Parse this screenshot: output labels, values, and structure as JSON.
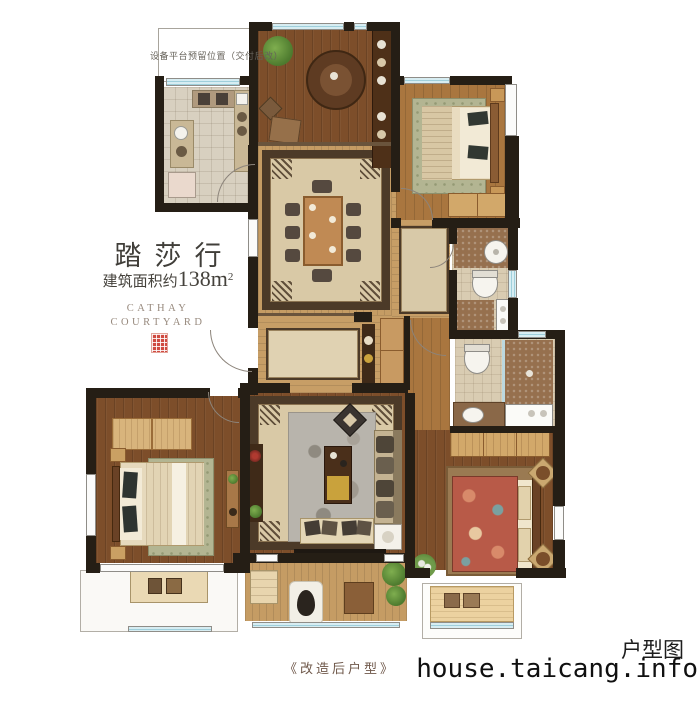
{
  "texts": {
    "platform_note": "设备平台预留位置（交付后改）",
    "title": "踏莎行",
    "area_prefix": "建筑面积约",
    "area_number": "138m",
    "area_sup": "2",
    "brand_line1": "CATHAY",
    "brand_line2": "COURTYARD",
    "caption": "《改造后户型》",
    "watermark_label": "户型图",
    "watermark_site": "house.taicang.info"
  },
  "colors": {
    "wall": "#251e15",
    "wood_dark": "#7d4e2a",
    "wood_mid": "#a9763f",
    "wood_light": "#c79e66",
    "rug_field": "#d9c9a6",
    "rug_border": "#4c3a28",
    "sage_rug": "#b3b592",
    "gray_rug": "#b8b4ac",
    "window_blue": "#9fcfdb",
    "seal_red": "#cf4a40"
  }
}
